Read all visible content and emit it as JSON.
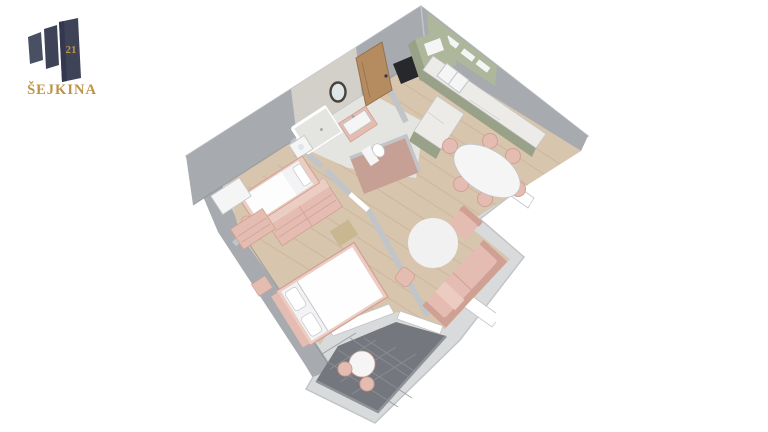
{
  "brand": {
    "building_number": "21",
    "name": "ŠEJKINA"
  },
  "scene": {
    "type": "isometric-3d-apartment-floor-plan",
    "background": "#ffffff"
  },
  "palette": {
    "bg": "#ffffff",
    "wall_top": "#d8dadb",
    "wall_face": "#a7abb0",
    "wall_face_dark": "#8f9398",
    "wall_line": "#c2c5c8",
    "wood": "#d8c5ae",
    "wood_line": "#c8b29a",
    "bath_floor": "#e4e4e1",
    "tile_wall": "#d3d0c9",
    "balcony_tile": "#74787e",
    "balcony_line": "#8f9399",
    "kitchen_green": "#aeb79c",
    "kitchen_green_dark": "#99a288",
    "counter": "#edebe8",
    "appliance_dark": "#26282c",
    "pink": "#e5bcb1",
    "pink_dark": "#cfa093",
    "pink_soft": "#eccdc3",
    "white_furniture": "#f5f5f6",
    "duvet": "#f3f3f5",
    "door_wood": "#b48c60",
    "door_wood_dark": "#97714a",
    "navy": "#3e4357",
    "navy_light": "#4a5064",
    "navy_dark": "#333850",
    "gold": "#bd9347",
    "rug": "#f3f3f4",
    "nook_pink": "#c7a095",
    "glass": "#dfe6e8",
    "white": "#ffffff",
    "mirror_frame": "#47423b"
  },
  "rooms": [
    {
      "id": "entry-hall",
      "items": [
        "entry-door"
      ]
    },
    {
      "id": "kitchen",
      "items": [
        "l-shaped-counter",
        "kitchen-sink",
        "tall-cabinet",
        "oven-column",
        "upper-cabinets"
      ]
    },
    {
      "id": "dining-area",
      "items": [
        "oval-table",
        "six-chairs",
        "armchair",
        "window"
      ]
    },
    {
      "id": "living-room",
      "items": [
        "sofa",
        "round-rug",
        "pouf",
        "window"
      ]
    },
    {
      "id": "bathroom",
      "items": [
        "round-mirror",
        "vanity-sink",
        "shower",
        "washing-machine",
        "toilet"
      ]
    },
    {
      "id": "master-bedroom",
      "items": [
        "double-bed",
        "wardrobe",
        "nightstand",
        "wood-shelf",
        "balcony-window"
      ]
    },
    {
      "id": "second-bedroom",
      "items": [
        "single-bed",
        "desk",
        "stool",
        "dresser"
      ]
    },
    {
      "id": "balcony",
      "items": [
        "round-table",
        "two-chairs",
        "dark-tile-floor"
      ]
    }
  ]
}
